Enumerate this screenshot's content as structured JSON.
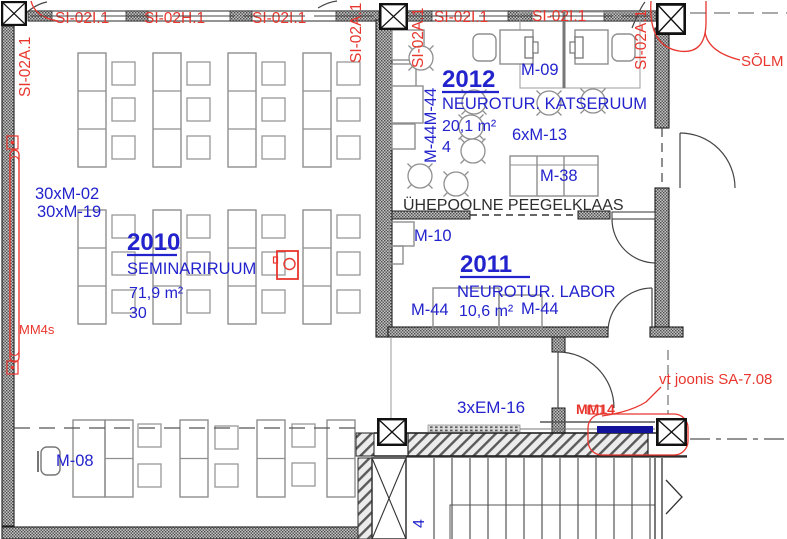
{
  "colors": {
    "blue": "#2323cd",
    "red": "#e8362e",
    "navy": "#11119a",
    "wall_dark": "#4a4a4a"
  },
  "axis": {
    "top": [
      "SI-02I.1",
      "SI-02H.1",
      "SI-02I.1",
      "SI-02I.1",
      "SI-02I.1"
    ],
    "vertical": [
      "SI-02A.1",
      "SI-02A.1",
      "SI-02A.1",
      "SI-02A.1"
    ]
  },
  "rooms": {
    "r2010": {
      "number": "2010",
      "name": "SEMINARIRUUM",
      "area": "71,9 m²",
      "capacity": "30"
    },
    "r2012": {
      "number": "2012",
      "name": "NEUROTUR. KATSERUUM",
      "area": "20,1 m²",
      "capacity": "4"
    },
    "r2011": {
      "number": "2011",
      "name": "NEUROTUR. LABOR",
      "area": "10,6 m²"
    }
  },
  "labels": {
    "m02": "30xM-02",
    "m19": "30xM-19",
    "m44v": "M-44M-44",
    "m09": "M-09",
    "m13": "6xM-13",
    "m38": "M-38",
    "m10": "M-10",
    "m44a": "M-44",
    "m44b": "M-44",
    "m08": "M-08",
    "em16": "3xEM-16",
    "mm14": "MM14",
    "mm4s": "MM4s",
    "stair4": "4"
  },
  "notes": {
    "mirror": "ÜHEPOOLNE PEEGELKLAAS",
    "node": "SÕLM 2",
    "ref": "vt joonis SA-7.08"
  }
}
